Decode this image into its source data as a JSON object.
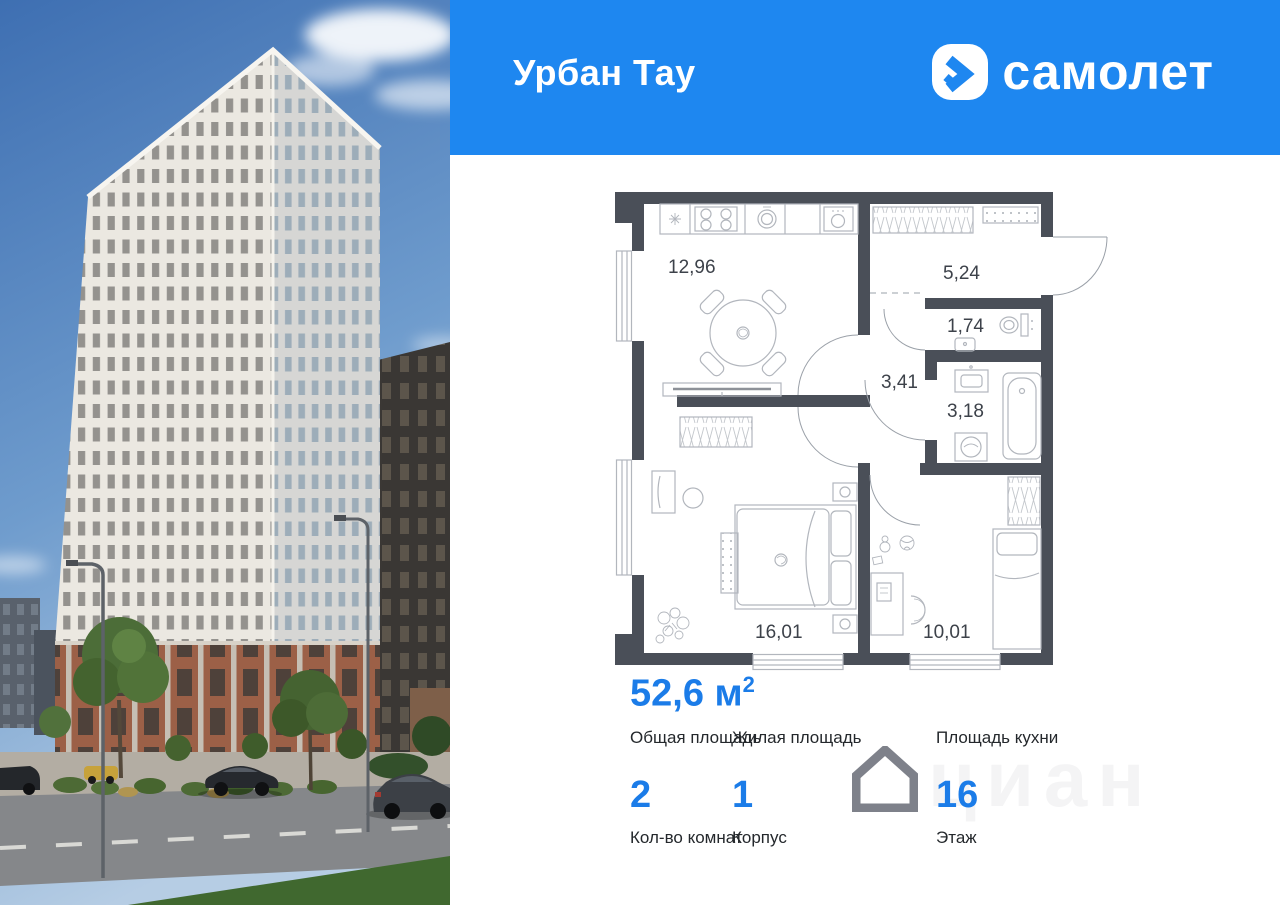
{
  "header": {
    "project_title": "Урбан Тау",
    "brand": "самолет",
    "bg_color": "#1e87f0"
  },
  "floor_plan": {
    "rooms": [
      {
        "name": "kitchen-living",
        "area": "12,96"
      },
      {
        "name": "hallway",
        "area": "5,24"
      },
      {
        "name": "wc",
        "area": "1,74"
      },
      {
        "name": "hall",
        "area": "3,41"
      },
      {
        "name": "bathroom",
        "area": "3,18"
      },
      {
        "name": "bedroom",
        "area": "16,01"
      },
      {
        "name": "kids-room",
        "area": "10,01"
      }
    ]
  },
  "details": {
    "total_area": {
      "value": "52,6",
      "unit": " м",
      "sup": "2",
      "label": "Общая площадь"
    },
    "living_area": {
      "label": "Жилая площадь"
    },
    "kitchen_area": {
      "label": "Площадь кухни"
    },
    "rooms_count": {
      "value": "2",
      "label": "Кол-во комнат"
    },
    "building": {
      "value": "1",
      "label": "Корпус"
    },
    "floor": {
      "value": "16",
      "label": "Этаж"
    }
  },
  "watermark": {
    "text": "циан"
  },
  "colors": {
    "accent_blue": "#1e87f0",
    "value_blue": "#1b7ce8",
    "plan_wall": "#4a4f58",
    "plan_lines": "#b2b6bd"
  }
}
